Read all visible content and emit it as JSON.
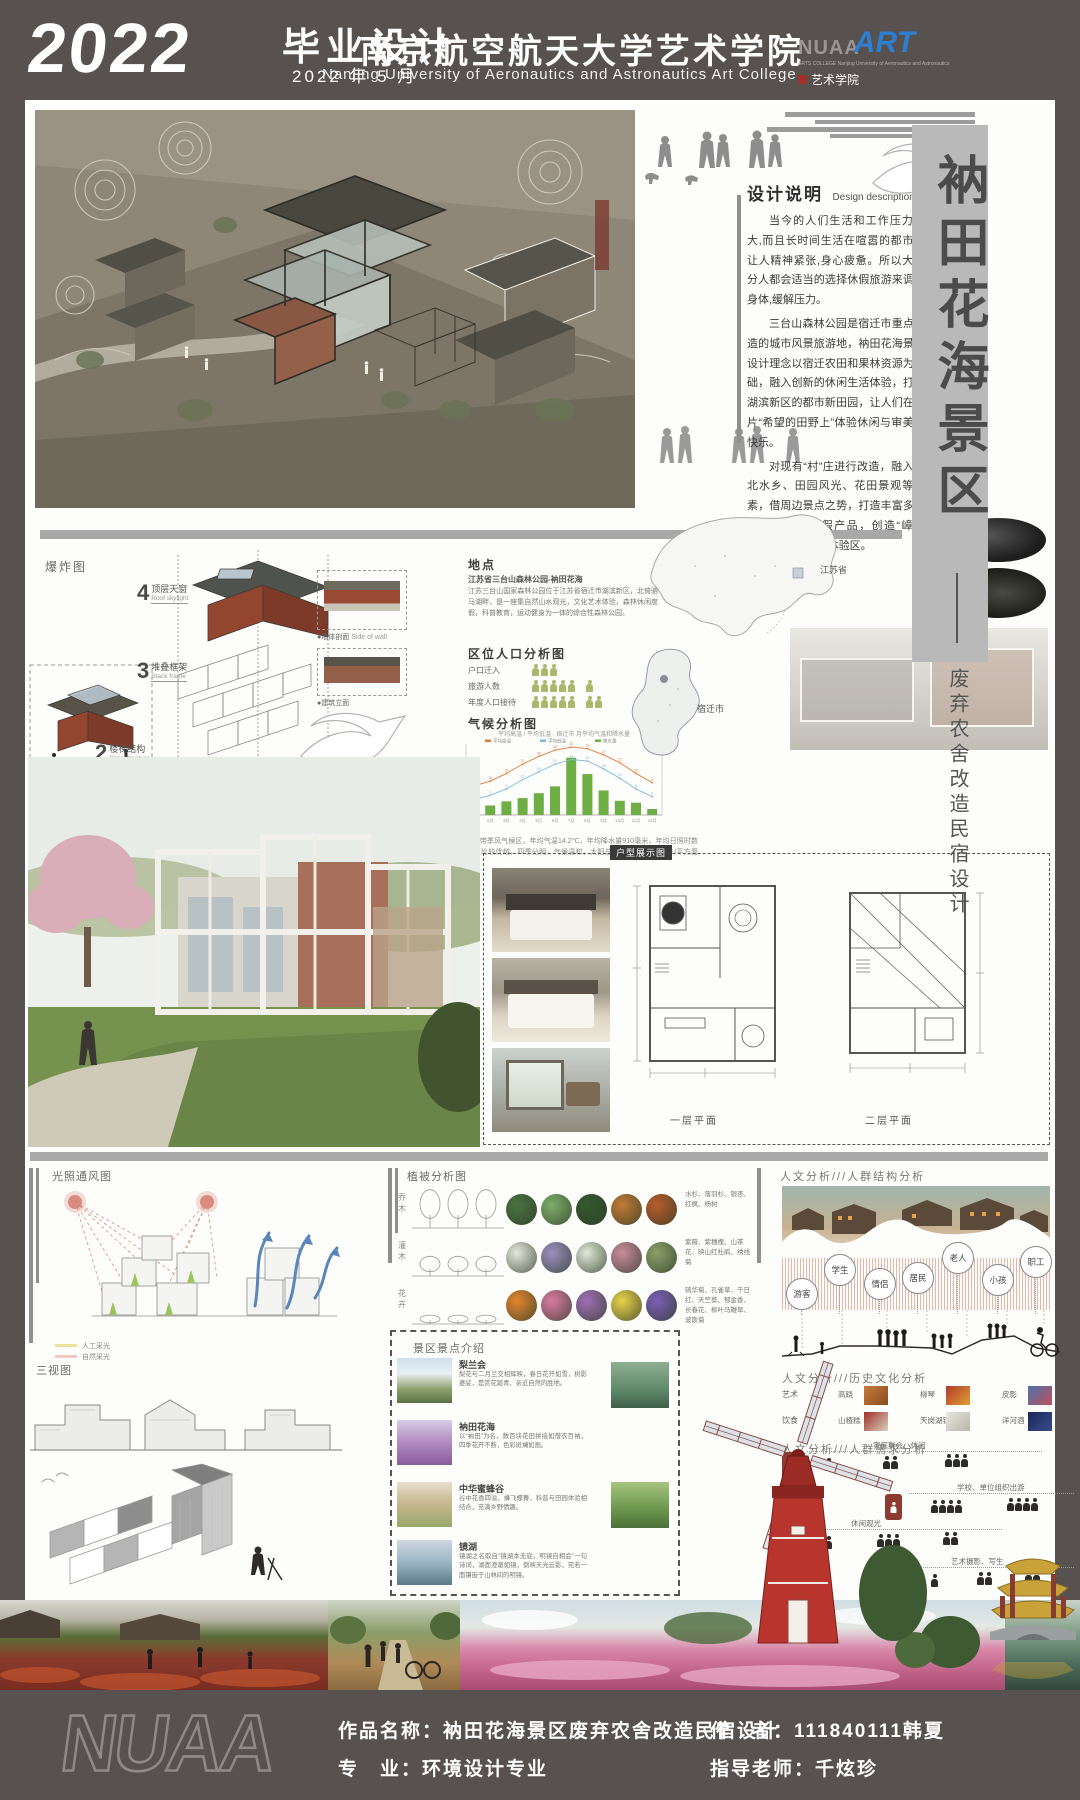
{
  "header": {
    "year": "2022",
    "program": "毕业设计",
    "date": "2022 年 5 月",
    "school_cn": "南京航空航天大学艺术学院",
    "school_en": "Nanjing University of Aeronautics and Astronautics Art College",
    "logo_nu": "NUAA",
    "logo_art": "ART",
    "logo_sub": "ARTS COLLEGE  Nanjing University of Aeronautics and Astronautics",
    "logo_college_cn": "艺术学院"
  },
  "banner": {
    "title": "衲田花海景区",
    "subtitle": "废弃农舍改造民宿设计"
  },
  "design_desc": {
    "title_cn": "设计说明",
    "title_en": "Design description",
    "p1": "当今的人们生活和工作压力很大,而且长时间生活在喧嚣的都市中让人精神紧张,身心疲惫。所以大部分人都会适当的选择休假旅游来调节身体,缓解压力。",
    "p2": "三台山森林公园是宿迁市重点打造的城市风景旅游地，衲田花海景区设计理念以宿迁农田和果林资源为基础，融入创新的休闲生活体验，打造湖滨新区的都市新田园，让人们在这片“希望的田野上”体验休闲与审美的快乐。",
    "p3": "对现有“村”庄进行改造，融入苏北水乡、田园风光、花田景观等元素，借周边景点之势，打造丰富多样的田园休闲度假产品，创造“嶂山下”特色森林休闲体验区。"
  },
  "exploded": {
    "label": "爆炸图",
    "steps": [
      {
        "num": "4",
        "cn": "顶层天窗",
        "en": "Roof skylight"
      },
      {
        "num": "3",
        "cn": "堆叠框架",
        "en": "Stack frame"
      },
      {
        "num": "2",
        "cn": "楼梯结构",
        "en": "Stair structure"
      },
      {
        "num": "1",
        "cn": "墙体",
        "en": "Wall body"
      }
    ],
    "callout_wall": "●墙体剖面",
    "callout_wall_en": "Side of wall",
    "callout_building": "●建筑立面"
  },
  "location": {
    "title": "地点",
    "line1": "江苏省三台山森林公园-衲田花海",
    "body": "江苏三台山国家森林公园位于江苏省宿迁市湖滨新区，北倚骆马湖畔，是一座集自然山水观光，文化艺术体验，森林休闲度假，科普教育，运动健身为一体的综合性森林公园。",
    "province_label": "江苏省",
    "city_label": "宿迁市"
  },
  "population": {
    "title": "区位人口分析图",
    "rows": [
      {
        "label": "户口迁入",
        "count": 3
      },
      {
        "label": "旅游人数",
        "count": 6
      },
      {
        "label": "年度人口接待",
        "count": 7
      }
    ]
  },
  "climate": {
    "title": "气候分析图",
    "chart_title": "宿迁市 月平均气温和降水量",
    "caption": "宿迁市属于暖温带季风气候区，年均气温14.2℃，年均降水量910毫米，年均日照时数充足。光热资源比较优越，四季分明，气候温和，太阳总辐射量约为117千卡/平方厘米。",
    "chart_data": {
      "type": "bar+line",
      "categories": [
        "1月",
        "2月",
        "3月",
        "4月",
        "5月",
        "6月",
        "7月",
        "8月",
        "9月",
        "10月",
        "11月",
        "12月"
      ],
      "series": [
        {
          "name": "降水量",
          "type": "bar",
          "values": [
            25,
            35,
            50,
            62,
            80,
            105,
            210,
            150,
            90,
            52,
            45,
            22
          ]
        },
        {
          "name": "平均高温",
          "type": "line",
          "values": [
            7,
            10,
            15,
            21,
            26,
            30,
            32,
            31,
            27,
            22,
            15,
            9
          ]
        },
        {
          "name": "平均低温",
          "type": "line",
          "values": [
            -2,
            1,
            5,
            11,
            16,
            21,
            24,
            23,
            18,
            12,
            5,
            0
          ]
        }
      ],
      "legend_position": "top",
      "ylabel_left": "降水量(mm)",
      "ylabel_right": "气温(℃)"
    }
  },
  "unit_plans": {
    "box_label": "户型展示图",
    "plan1": "一层平面",
    "plan2": "二层平面"
  },
  "analysis_left": {
    "sunwind_title": "光照通风图",
    "legend": [
      {
        "color": "#e9e29b",
        "label": "人工采光"
      },
      {
        "color": "#f2cbc6",
        "label": "自然采光"
      }
    ],
    "views_title": "三视图"
  },
  "vegetation": {
    "title": "植被分析图",
    "rows": [
      {
        "label": "乔木",
        "plants": "水杉、落羽杉、银杏、红枫、杨树"
      },
      {
        "label": "灌木",
        "plants": "紫薇、紫穗槐、山茶花、映山红杜鹃、绣线菊"
      },
      {
        "label": "花卉",
        "plants": "硫华菊、孔雀草、千日红、天竺葵、郁金香、长春花、柳叶马鞭草、波斯菊"
      }
    ]
  },
  "spots": {
    "title": "景区景点介绍",
    "items": [
      {
        "name": "梨兰会",
        "desc": "梨花与二月兰交相辉映，春日花开如雪，树影婆娑，是赏花踏青、亲近自然的胜地。"
      },
      {
        "name": "衲田花海",
        "desc": "以“衲田”为名，数百块花田拼接如僧衣百衲，四季花开不断，色彩斑斓如画。"
      },
      {
        "name": "中华蜜蜂谷",
        "desc": "谷中花香四溢，蜂飞蝶舞，科普与田园体验相结合，充满乡野情趣。"
      },
      {
        "name": "镜湖",
        "desc": "镜湖之名取自“镜湖本无底，明镜自相会”一句诗词，湖面澄澈如镜，倒映天光云影，宛若一面镶嵌于山林间的明镜。"
      }
    ]
  },
  "humanities": {
    "crowd_title": "人文分析///人群结构分析",
    "crowd_groups": [
      "游客",
      "学生",
      "情侣",
      "居民",
      "老人",
      "小孩",
      "职工"
    ],
    "history_title": "人文分析///历史文化分析",
    "history_rows": [
      {
        "cat": "艺术",
        "items": [
          "高跷",
          "柳琴",
          "皮影"
        ]
      },
      {
        "cat": "饮食",
        "items": [
          "山楂糕",
          "天岗湖银鱼",
          "洋河酒"
        ]
      }
    ],
    "needs_title": "人文分析///人群需求分析",
    "needs": [
      "家庭聚会、休闲",
      "学校、单位组织出游",
      "休闲观光",
      "艺术摄影、写生"
    ]
  },
  "footer": {
    "logo": "NUAA",
    "work_label": "作品名称：",
    "work": "衲田花海景区废弃农舍改造民宿设计",
    "major_label": "专　业：",
    "major": "环境设计专业",
    "author_label": "作　者：",
    "author": "111840111韩夏",
    "advisor_label": "指导老师：",
    "advisor": "千炫珍"
  },
  "colors": {
    "frame": "#575150",
    "banner_gray": "#b9b9b9",
    "accent_red": "#8e3a31",
    "bar_green": "#6fae44",
    "line_high": "#e07b39",
    "line_low": "#85b7d9"
  }
}
